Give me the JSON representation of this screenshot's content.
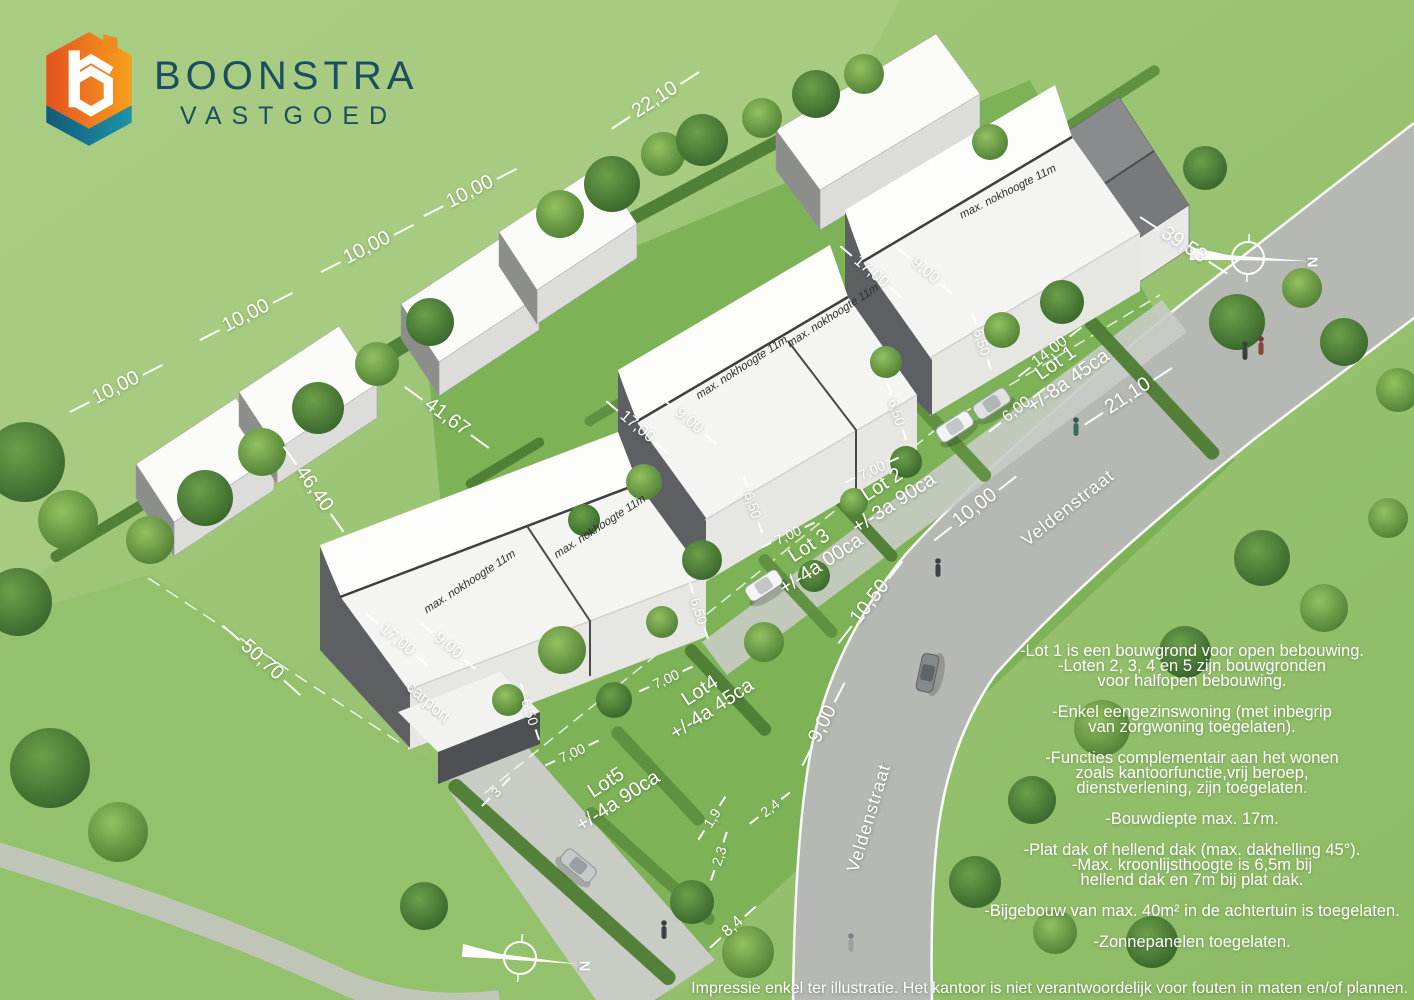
{
  "logo": {
    "title": "BOONSTRA",
    "subtitle": "VASTGOED"
  },
  "colors": {
    "logo_orange": "#f6a11c",
    "logo_orange_dark": "#e4511f",
    "logo_teal": "#1e93a8",
    "logo_teal_dark": "#115a78",
    "logo_text": "#1d4e60",
    "grass": "#9cc274",
    "garden": "#7db257",
    "road": "#b7bab4",
    "hedge": "#4f7e35",
    "roof_white": "#fafafa",
    "wall_dark": "#5d5f63",
    "label_white": "#ffffff"
  },
  "compass": {
    "label": "N"
  },
  "street": {
    "name": "Veldenstraat"
  },
  "houses": {
    "roof_note": "max. nokhoogte 11m",
    "carport": "carport"
  },
  "lots": [
    {
      "name": "Lot 1",
      "area": "+/-8a 45ca"
    },
    {
      "name": "Lot 2",
      "area": "+/-3a 90ca"
    },
    {
      "name": "Lot 3",
      "area": "+/-4a 00ca"
    },
    {
      "name": "Lot4",
      "area": "+/-4a 45ca"
    },
    {
      "name": "Lot5",
      "area": "+/-4a 90ca"
    }
  ],
  "dims": {
    "d22_10": "22,10",
    "d10_00": "10,00",
    "d39_53": "39,53",
    "d41_67": "41,67",
    "d46_40": "46,40",
    "d50_70": "50,70",
    "d21_10": "21,10",
    "d14_00": "14,00",
    "d6_00": "6,00",
    "d10_50": "10,50",
    "d9_00": "9,00",
    "d8_4": "8,4",
    "d17_00": "17,00",
    "d6_50": "6,50",
    "d7_00": "7,00",
    "d2_4": "2,4",
    "d1_9": "1,9",
    "d2_3": "2,3",
    "d3": "3"
  },
  "regulations": [
    "-Lot 1 is een bouwgrond voor open bebouwing.\n-Loten 2, 3, 4 en 5 zijn bouwgronden\nvoor halfopen bebouwing.",
    "-Enkel eengezinswoning (met inbegrip\nvan zorgwoning toegelaten).",
    "-Functies complementair aan het wonen\nzoals kantoorfunctie,vrij beroep,\ndienstverlening, zijn toegelaten.",
    "-Bouwdiepte max. 17m.",
    "-Plat dak of hellend dak (max. dakhelling 45°).\n-Max. kroonlijsthoogte is 6,5m bij\nhellend dak en 7m bij plat dak.",
    "-Bijgebouw van max. 40m² in de achtertuin is toegelaten.",
    "-Zonnepanelen toegelaten."
  ],
  "disclaimer": "Impressie enkel ter illustratie. Het kantoor is niet verantwoordelijk voor fouten in maten en/of plannen."
}
